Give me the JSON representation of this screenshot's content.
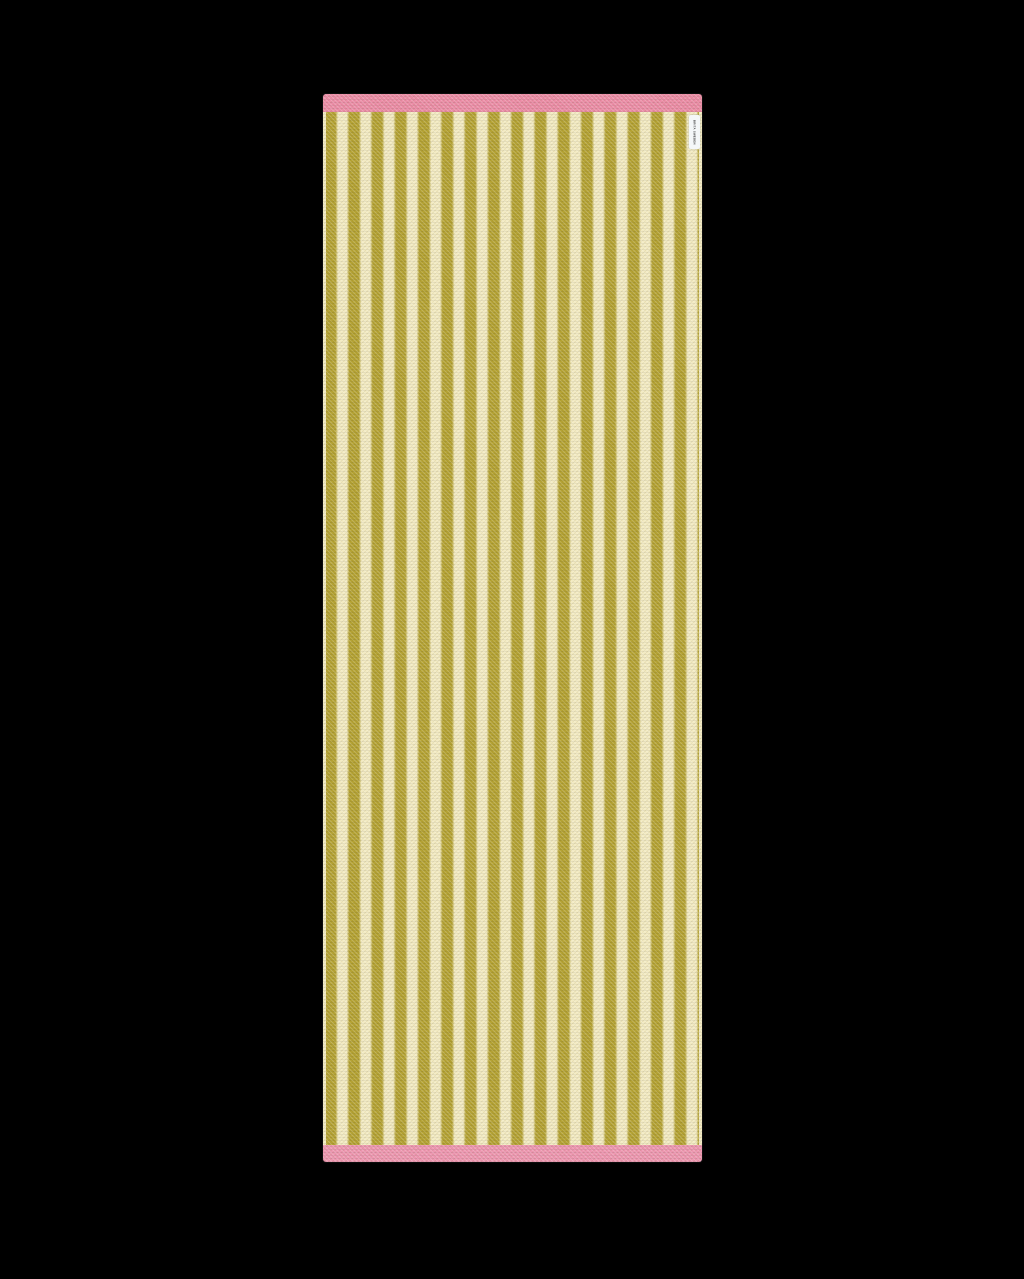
{
  "rug": {
    "label_text": "BRITA SWEDEN",
    "stripe_count": 16,
    "pattern": "vertical-stripes",
    "parts": {
      "top_border": "pink woven band",
      "field": "alternating olive and cream vertical stripes",
      "bottom_border": "pink woven band"
    }
  },
  "colors": {
    "bg": "#000000",
    "stripe_olive": "#b4a233",
    "stripe_cream": "#f3ebc3",
    "pink_top": "#ec8ca7",
    "pink_bottom": "#ee96b1",
    "label_bg": "#f4f7f8",
    "label_text_color": "#3a3a3a"
  }
}
